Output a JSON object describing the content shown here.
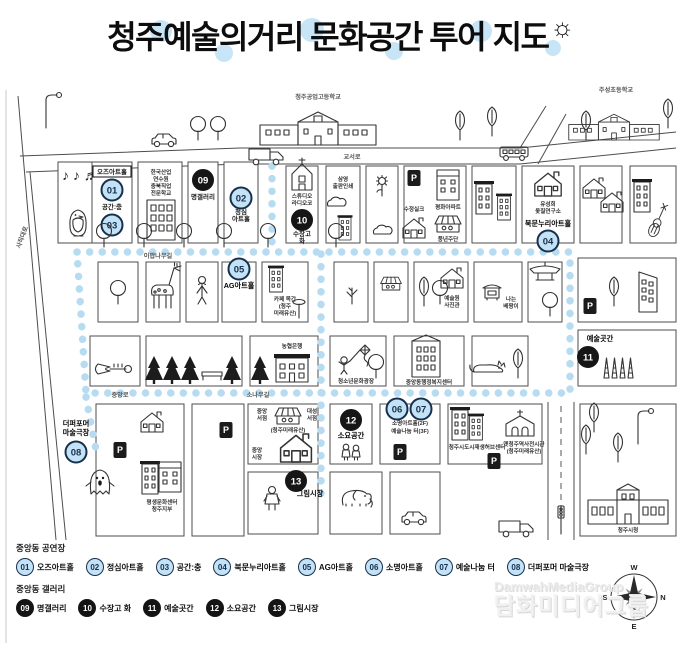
{
  "title": {
    "text": "청주예술의거리 문화공간 투어 지도",
    "sun": "☼"
  },
  "icons": {
    "notes": "♪ ♪ ♬"
  },
  "colors": {
    "path_blue": "#b7dcf1",
    "badge_blue_fill": "#c3e2f6",
    "badge_blue_border": "#17304d",
    "badge_black": "#161616",
    "ink": "#333333",
    "watermark": "#ececec"
  },
  "map": {
    "roads": {
      "sajik": "사직대로",
      "gyoseo": "교서로",
      "ipap": "이팝나무길",
      "jungang": "중앙로",
      "sonamu": "소나무길"
    },
    "badges": {
      "n01": "01",
      "n02": "02",
      "n03": "03",
      "n04": "04",
      "n05": "05",
      "n06": "06",
      "n07": "07",
      "n08": "08",
      "n09": "09",
      "n10": "10",
      "n11": "11",
      "n12": "12",
      "n13": "13",
      "p": "P"
    },
    "labels": {
      "gongko": "청주공업고등학교",
      "juseong": "주성초등학교",
      "ozu": "오즈아트홀",
      "gonggan": "공간:충",
      "hanguk": [
        "한국산업",
        "연수원",
        "충북직업",
        "전문학교"
      ],
      "myeong": "명갤러리",
      "jeongsim": [
        "정심",
        "아트홀"
      ],
      "studio": [
        "스튜디오",
        "라디오코"
      ],
      "sujanggo": [
        "수장고",
        "화"
      ],
      "samyoung": [
        "삼영",
        "출판인쇄"
      ],
      "sujeong": "수정실크",
      "pyeonghwa": "평화아파트",
      "pungnyeon": "풍년주단",
      "yusunghee": [
        "유성희",
        "옻칠연구소"
      ],
      "bukmun": "북문누리아트홀",
      "ag": "AG아트홀",
      "cafe": [
        "카페 목간",
        "(청주",
        "미래유산)"
      ],
      "yesulwon": [
        "예술원",
        "사진관"
      ],
      "naneun": [
        "나는",
        "베짱이"
      ],
      "nonghyup": "농협은행",
      "youth": "청소년문화광장",
      "welfare": "중앙동행정복지센터",
      "yesulgotgan": "예술곳간",
      "perf": [
        "더퍼포머",
        "마술극장"
      ],
      "bookJ": [
        "중앙",
        "서점"
      ],
      "bookD": [
        "대성",
        "서점"
      ],
      "heritage": "(청주미래유산)",
      "marketJ": [
        "중앙",
        "시장"
      ],
      "soyo": "소요공간",
      "somyeong": [
        "소명아트홀(2F)",
        "예술나눔 터(3F)"
      ],
      "geurim": "그림시장",
      "pyeongsaeng": [
        "평생문화센터",
        "청주지부"
      ],
      "hub": "청주시도시재생허브센터",
      "oldstation": [
        "옛청주역사전시관",
        "(청주미래유산)"
      ],
      "cityhall": "청주시청"
    }
  },
  "legend": {
    "row1_title": "중앙동 공연장",
    "row1": [
      {
        "num": "01",
        "label": "오즈아트홀"
      },
      {
        "num": "02",
        "label": "정심아트홀"
      },
      {
        "num": "03",
        "label": "공간:충"
      },
      {
        "num": "04",
        "label": "북문누리아트홀"
      },
      {
        "num": "05",
        "label": "AG아트홀"
      },
      {
        "num": "06",
        "label": "소명아트홀"
      },
      {
        "num": "07",
        "label": "예술나눔 터"
      },
      {
        "num": "08",
        "label": "더퍼포머 마술극장"
      }
    ],
    "row2_title": "중앙동 갤러리",
    "row2": [
      {
        "num": "09",
        "label": "명갤러리"
      },
      {
        "num": "10",
        "label": "수장고 화"
      },
      {
        "num": "11",
        "label": "예술곳간"
      },
      {
        "num": "12",
        "label": "소요공간"
      },
      {
        "num": "13",
        "label": "그림시장"
      }
    ]
  },
  "compass": {
    "n": "N",
    "s": "S",
    "e": "E",
    "w": "W"
  },
  "watermark": {
    "line1": "DamwahMediaGroup",
    "line2": "담화미디어그룹"
  }
}
